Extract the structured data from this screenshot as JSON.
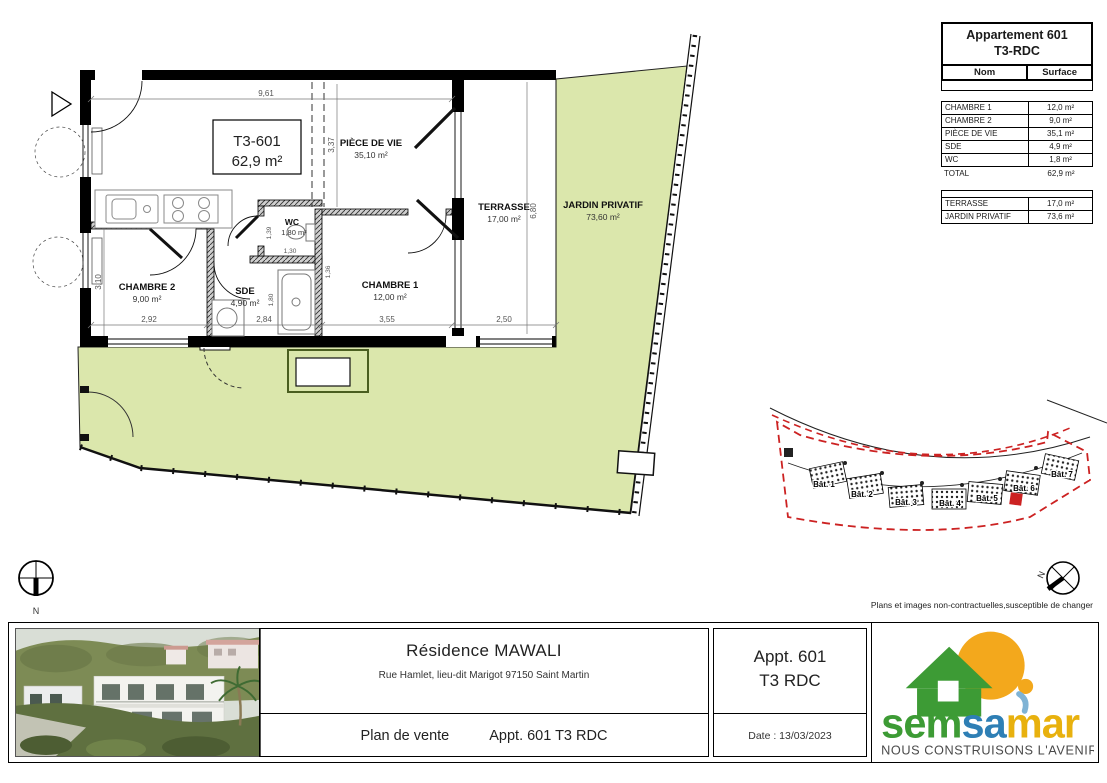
{
  "disclaimer": "Plans et images non-contractuelles,susceptible de changer",
  "colors": {
    "garden": "#dbe7ac",
    "site_red": "#cc2222",
    "logo_green": "#3d9b35",
    "logo_blue": "#2e7fb5",
    "logo_gold": "#e8b10e",
    "logo_sun": "#f3a81c"
  },
  "info_panel": {
    "title_line1": "Appartement 601",
    "title_line2": "T3-RDC",
    "col_name": "Nom",
    "col_surface": "Surface",
    "rooms": [
      {
        "name": "CHAMBRE 1",
        "surface": "12,0 m²"
      },
      {
        "name": "CHAMBRE 2",
        "surface": "9,0 m²"
      },
      {
        "name": "PIÈCE DE VIE",
        "surface": "35,1 m²"
      },
      {
        "name": "SDE",
        "surface": "4,9 m²"
      },
      {
        "name": "WC",
        "surface": "1,8 m²"
      }
    ],
    "total_name": "TOTAL",
    "total_surface": "62,9 m²",
    "ext": [
      {
        "name": "TERRASSE",
        "surface": "17,0 m²"
      },
      {
        "name": "JARDIN PRIVATIF",
        "surface": "73,6 m²"
      }
    ]
  },
  "plan": {
    "unit_code": "T3-601",
    "unit_area": "62,9 m²",
    "labels": {
      "piece_de_vie": {
        "name": "PIÈCE DE VIE",
        "area": "35,10 m²"
      },
      "wc": {
        "name": "WC",
        "area": "1,80 m²"
      },
      "terrasse": {
        "name": "TERRASSE",
        "area": "17,00 m²"
      },
      "jardin": {
        "name": "JARDIN PRIVATIF",
        "area": "73,60 m²"
      },
      "chambre2": {
        "name": "CHAMBRE 2",
        "area": "9,00 m²"
      },
      "sde": {
        "name": "SDE",
        "area": "4,90 m²"
      },
      "chambre1": {
        "name": "CHAMBRE 1",
        "area": "12,00 m²"
      }
    },
    "dims": {
      "top": "9,61",
      "c2_w": "2,92",
      "sde_w": "2,84",
      "c1_w": "3,55",
      "ter_w": "2,50",
      "c2_h": "3,10",
      "pv_h": "3,37",
      "ter_h": "6,80",
      "wc_h": "1,39",
      "wc_w": "1,30",
      "sde_h": "1,80",
      "hall_h": "1,36"
    },
    "north": "N"
  },
  "site_plan": {
    "buildings": [
      "Bât. 1",
      "Bât. 2",
      "Bât. 3",
      "Bât. 4",
      "Bât. 5",
      "Bât. 6",
      "Bât. 7"
    ],
    "north": "N"
  },
  "title_block": {
    "residence": "Résidence MAWALI",
    "address": "Rue Hamlet, lieu-dit Marigot 97150 Saint Martin",
    "doc_type": "Plan de vente",
    "unit_ref": "Appt. 601  T3 RDC",
    "apt_line1": "Appt. 601",
    "apt_line2": "T3 RDC",
    "date": "Date : 13/03/2023",
    "logo": {
      "sem": "sem",
      "sa": "sa",
      "mar": "mar",
      "tagline": "NOUS CONSTRUISONS L'AVENIR"
    }
  }
}
